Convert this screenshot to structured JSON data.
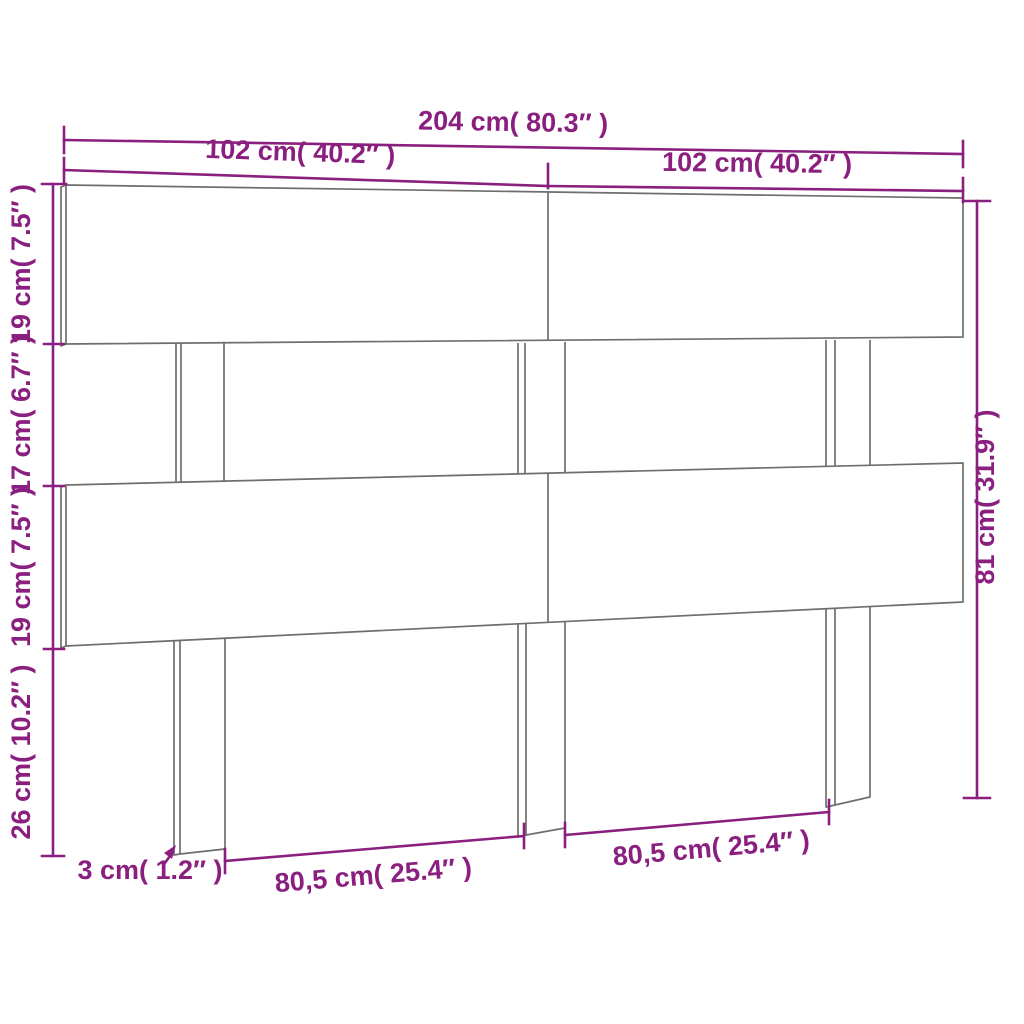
{
  "diagram": {
    "type": "furniture-dimension-drawing",
    "subject": "slatted headboard with legs",
    "colors": {
      "dimension": "#8a1f7f",
      "structure": "#6e6e6e",
      "background": "#ffffff"
    },
    "dimensions": {
      "total_width": "204 cm( 80.3″ )",
      "panel_width_left": "102 cm( 40.2″ )",
      "panel_width_right": "102 cm( 40.2″ )",
      "slat_top_height": "19 cm( 7.5″ )",
      "gap_height": "17 cm( 6.7″ )",
      "slat_middle_height": "19 cm( 7.5″ )",
      "leg_height": "26 cm( 10.2″ )",
      "total_height": "81 cm( 31.9″ )",
      "leg_thickness": "3 cm( 1.2″ )",
      "span_left": "80,5 cm( 25.4″ )",
      "span_right": "80,5 cm( 25.4″ )"
    }
  }
}
